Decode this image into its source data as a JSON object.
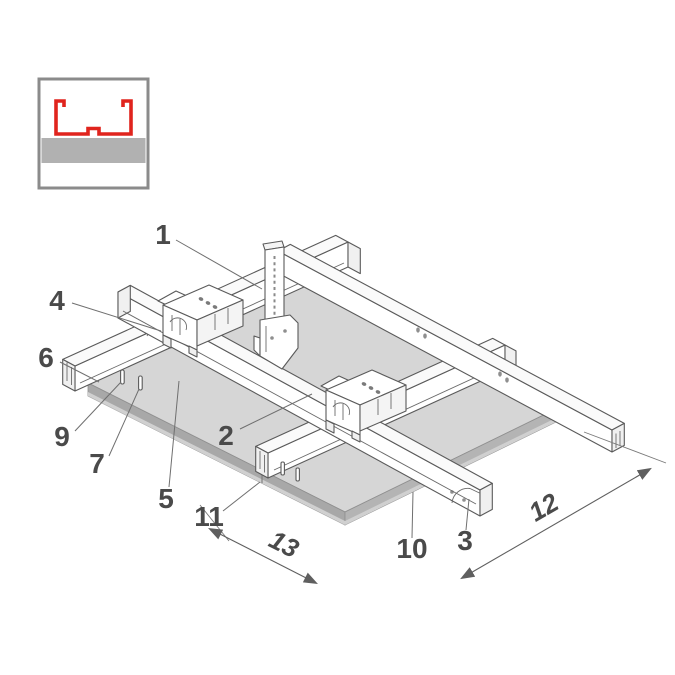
{
  "legend": {
    "name": "profile-cross-section-inset",
    "profile_color": "#e0241d",
    "board_color": "#b1b1b1",
    "border_color": "#8b8b8b"
  },
  "diagram": {
    "type": "isometric-technical-drawing",
    "subject": "suspended ceiling substructure with hanger, channels, cross connectors and boards",
    "callouts": {
      "c1": "1",
      "c2": "2",
      "c3": "3",
      "c4": "4",
      "c5": "5",
      "c6": "6",
      "c7": "7",
      "c9": "9",
      "c10": "10",
      "c11": "11"
    },
    "dimensions": {
      "d12": "12",
      "d13": "13"
    },
    "colors": {
      "line": "#5a5a5a",
      "label": "#4a4a4a",
      "panel_top": "#d6d6d6",
      "panel_edge": "#a8a8a8",
      "panel_edge_light": "#d0d0d0",
      "accent_red": "#e0241d"
    }
  }
}
